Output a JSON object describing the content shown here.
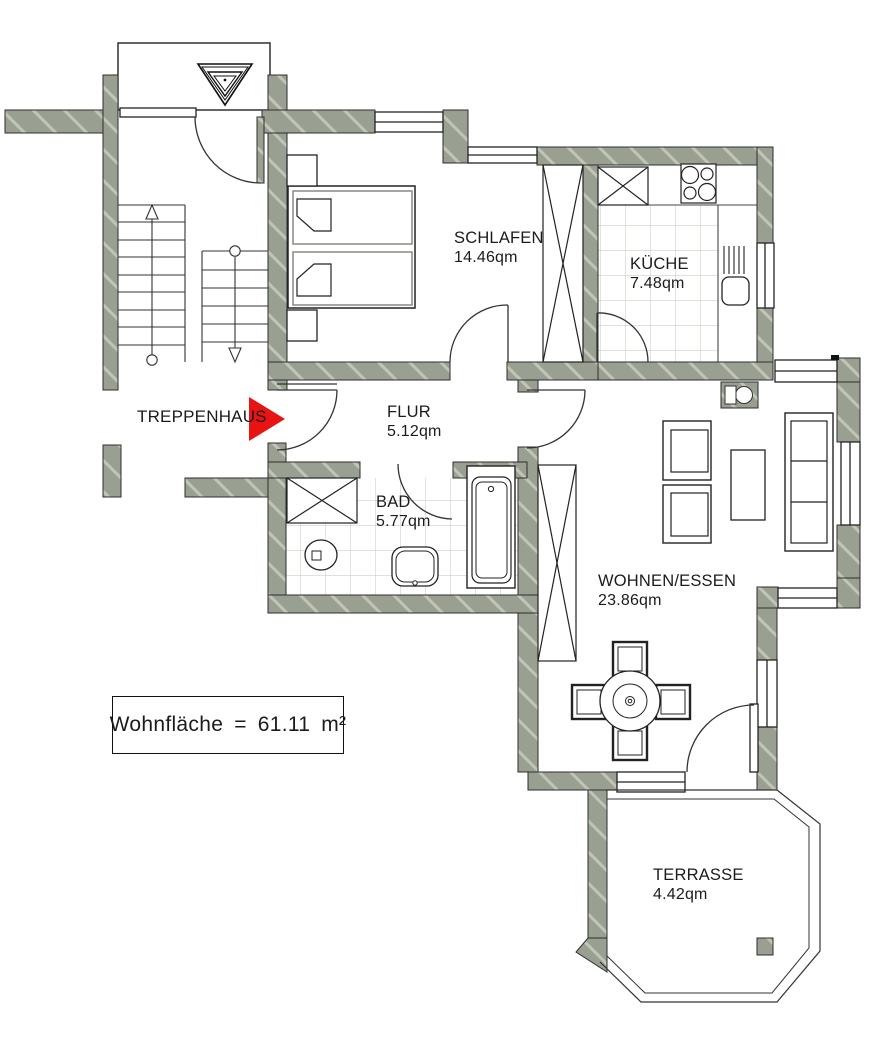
{
  "plan": {
    "stairwell_label": "TREPPENHAUS",
    "rooms": [
      {
        "name": "SCHLAFEN",
        "area": "14.46qm"
      },
      {
        "name": "KÜCHE",
        "area": "7.48qm"
      },
      {
        "name": "FLUR",
        "area": "5.12qm"
      },
      {
        "name": "BAD",
        "area": "5.77qm"
      },
      {
        "name": "WOHNEN/ESSEN",
        "area": "23.86qm"
      },
      {
        "name": "TERRASSE",
        "area": "4.42qm"
      }
    ],
    "summary": {
      "label": "Wohnfläche",
      "equals": "=",
      "value": "61.11",
      "unit": "m²"
    },
    "colors": {
      "wall": "#9aa091",
      "arrow_red": "#e81414",
      "tile_line": "#ccd1c2"
    }
  }
}
